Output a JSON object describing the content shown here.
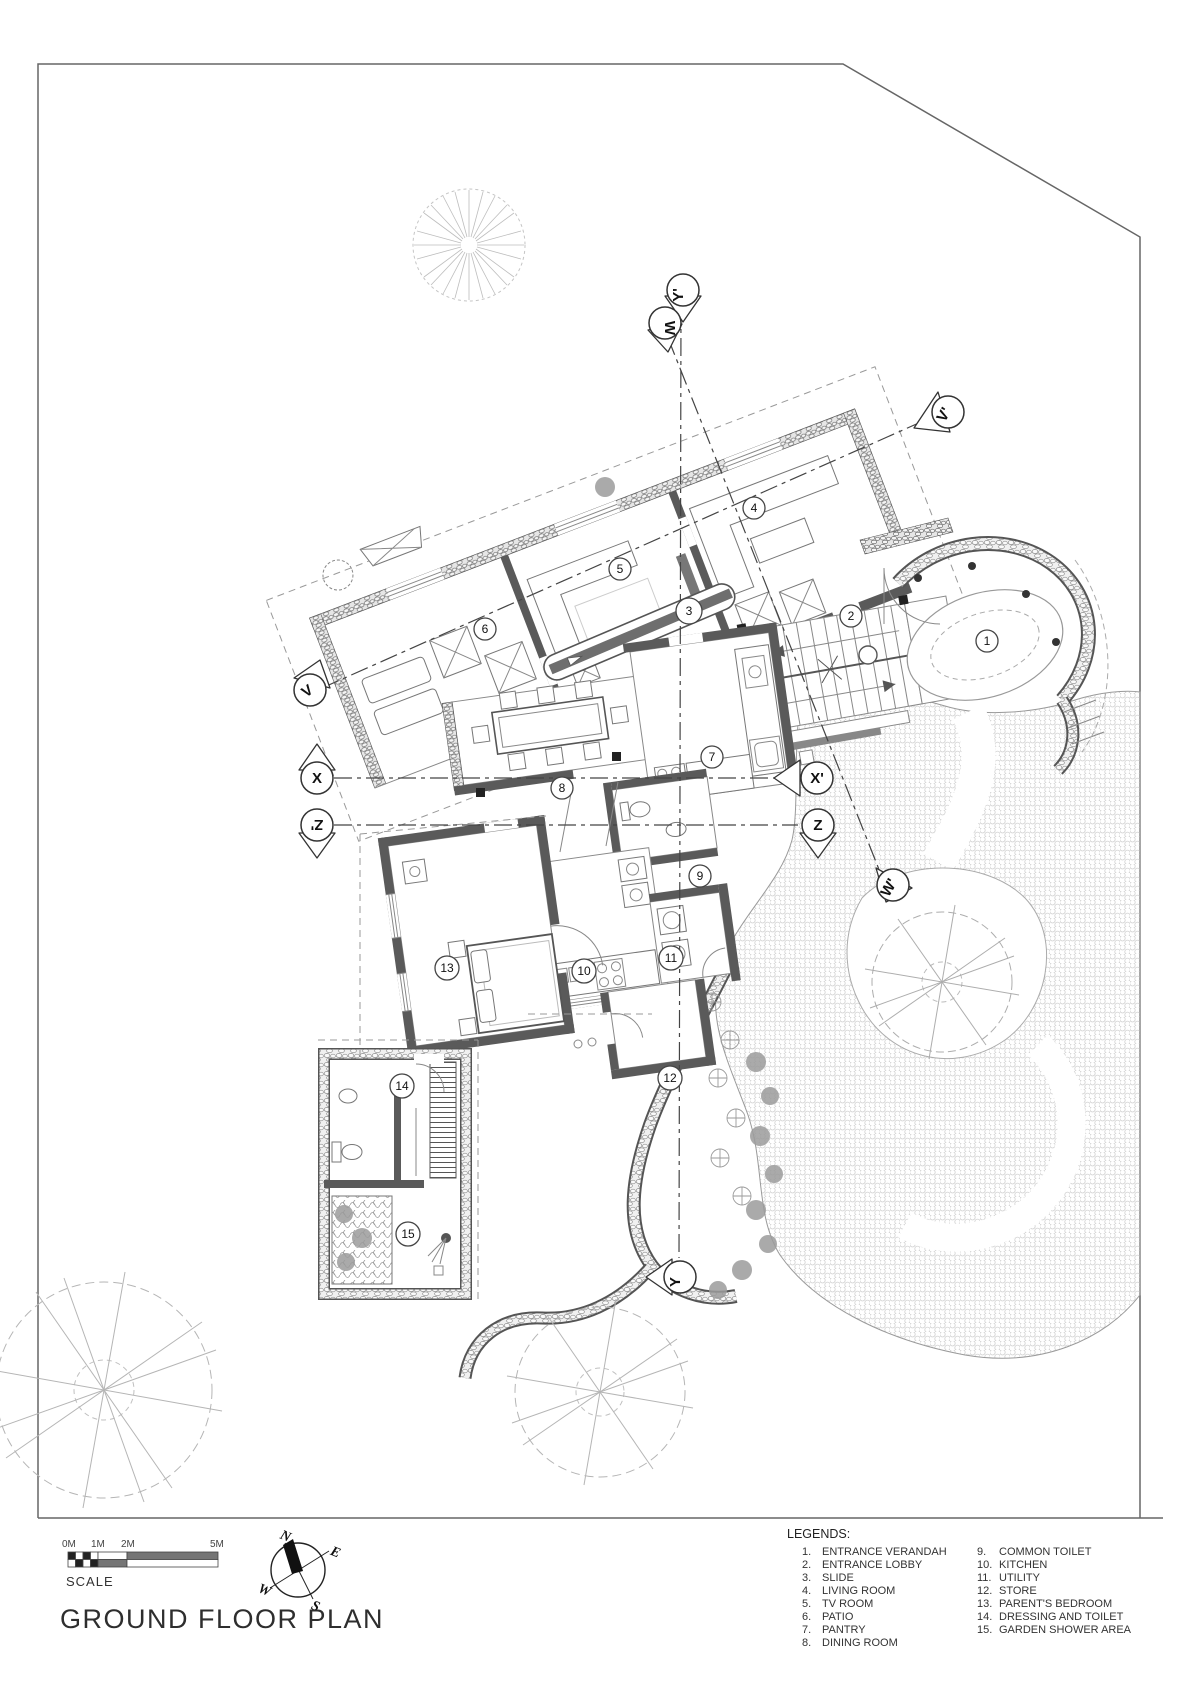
{
  "title": "GROUND FLOOR PLAN",
  "scale": {
    "label": "SCALE",
    "ticks": [
      "0M",
      "1M",
      "2M",
      "5M"
    ]
  },
  "compass": {
    "n": "N",
    "e": "E",
    "s": "S",
    "w": "W"
  },
  "legend": {
    "heading": "LEGENDS:",
    "col1": [
      {
        "num": "1.",
        "label": "ENTRANCE VERANDAH"
      },
      {
        "num": "2.",
        "label": "ENTRANCE LOBBY"
      },
      {
        "num": "3.",
        "label": "SLIDE"
      },
      {
        "num": "4.",
        "label": "LIVING ROOM"
      },
      {
        "num": "5.",
        "label": "TV ROOM"
      },
      {
        "num": "6.",
        "label": "PATIO"
      },
      {
        "num": "7.",
        "label": "PANTRY"
      },
      {
        "num": "8.",
        "label": "DINING ROOM"
      }
    ],
    "col2": [
      {
        "num": "9.",
        "label": "COMMON TOILET"
      },
      {
        "num": "10.",
        "label": "KITCHEN"
      },
      {
        "num": "11.",
        "label": "UTILITY"
      },
      {
        "num": "12.",
        "label": "STORE"
      },
      {
        "num": "13.",
        "label": "PARENT'S BEDROOM"
      },
      {
        "num": "14.",
        "label": "DRESSING AND TOILET"
      },
      {
        "num": "15.",
        "label": "GARDEN SHOWER AREA"
      }
    ]
  },
  "rooms": [
    "1",
    "2",
    "3",
    "4",
    "5",
    "6",
    "7",
    "8",
    "9",
    "10",
    "11",
    "12",
    "13",
    "14",
    "15"
  ],
  "sections": {
    "v": "V",
    "v_prime": "V'",
    "w": "W",
    "w_prime": "W'",
    "x": "X",
    "x_prime": "X'",
    "y": "Y",
    "y_prime": "Y'",
    "z": "Z",
    "z_prime": "Z'"
  },
  "stairs": {
    "up": "UP",
    "down": "DN"
  },
  "colors": {
    "ink": "#333333",
    "wall": "#5a5a5a",
    "shrub": "#9b9b9b",
    "pattern": "#cfcfcf"
  }
}
